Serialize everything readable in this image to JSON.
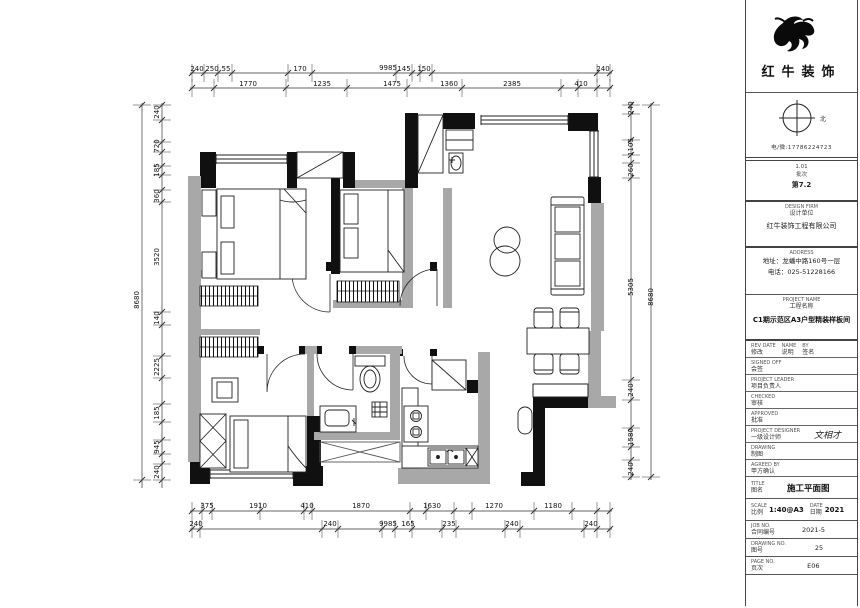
{
  "title_block": {
    "brand": "红牛装饰",
    "north_label": "北",
    "hotline": "电/微:17786224723",
    "meta": {
      "line1": "1.01",
      "line2": "批次",
      "line3": "第7.2"
    },
    "firm": {
      "en": "DESIGN FIRM",
      "cn": "设计单位",
      "name": "红牛装饰工程有限公司"
    },
    "contact": {
      "en": "ADDRESS",
      "cn": "公司地址",
      "line1": "地址：龙蟠中路160号一层",
      "line2": "电话：025-51228166"
    },
    "project": {
      "en": "PROJECT NAME",
      "cn": "工程名称",
      "name": "C1期示范区A3户型精装样板间"
    },
    "sign_rows": [
      {
        "en": "REV DATE",
        "cn": "修改",
        "mid_en": "NAME",
        "mid_cn": "说明",
        "r_en": "BY",
        "r_cn": "签名",
        "value": ""
      },
      {
        "en": "SIGNED OFF",
        "cn": "会签",
        "value": ""
      },
      {
        "en": "PROJECT LEADER",
        "cn": "项目负责人",
        "value": ""
      },
      {
        "en": "CHECKED",
        "cn": "审核",
        "value": ""
      },
      {
        "en": "APPROVED",
        "cn": "批准",
        "value": ""
      },
      {
        "en": "PROJECT DESIGNER",
        "cn": "一级设计师",
        "value": "文相才"
      },
      {
        "en": "DRAWING",
        "cn": "制图",
        "value": ""
      },
      {
        "en": "AGREED BY",
        "cn": "甲方确认",
        "value": ""
      }
    ],
    "title_row": {
      "en": "TITLE",
      "cn": "图名",
      "value": "施工平面图"
    },
    "scale_row": {
      "en": "SCALE",
      "cn": "比例",
      "value": "1:40@A3",
      "en2": "DATE",
      "cn2": "日期",
      "value2": "2021"
    },
    "job_row": {
      "en": "JOB NO.",
      "cn": "合同编号",
      "value": "2021-5"
    },
    "dwg_row": {
      "en": "DRAWING NO.",
      "cn": "图号",
      "value": "25"
    },
    "page_row": {
      "en": "PAGE NO.",
      "cn": "页次",
      "value": "E06"
    }
  },
  "dims": {
    "top_overall": "9985",
    "top_small": [
      "240",
      "250",
      "55",
      "170",
      "145",
      "150",
      "240"
    ],
    "top_rooms": [
      "1770",
      "1235",
      "1475",
      "1360",
      "2385",
      "410"
    ],
    "bottom_rooms": [
      "375",
      "1910",
      "410",
      "1870",
      "1630",
      "1270",
      "1180"
    ],
    "bottom_small": [
      "240",
      "240",
      "9985",
      "165",
      "235",
      "240",
      "240"
    ],
    "left_outer": "8680",
    "left_chain": [
      "240",
      "720",
      "185",
      "360",
      "3520",
      "140",
      "2225",
      "185",
      "945",
      "240"
    ],
    "right_outer": "8680",
    "right_chain": [
      "240",
      "1105",
      "260",
      "5305",
      "240",
      "1580",
      "240"
    ]
  }
}
